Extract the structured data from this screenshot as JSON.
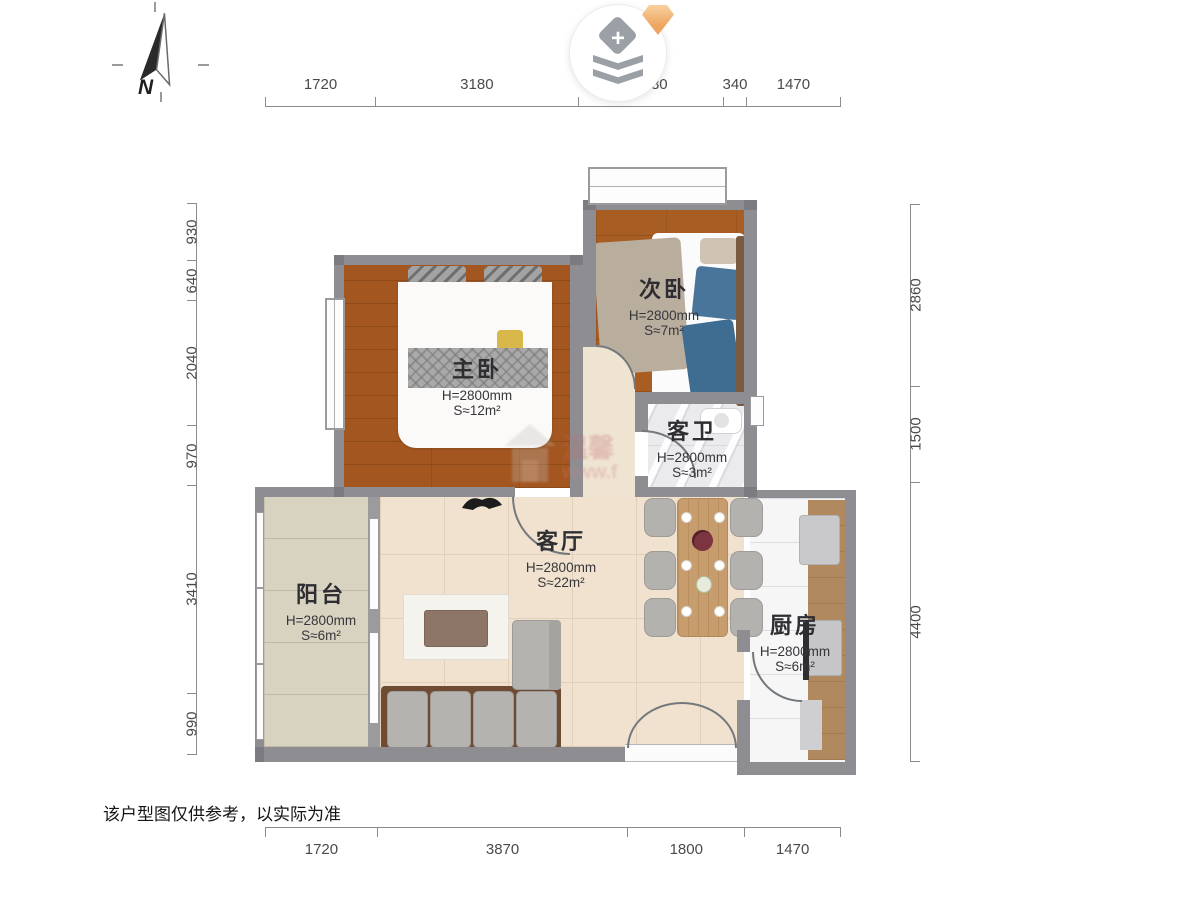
{
  "compass": {
    "label": "N"
  },
  "logo": {
    "plus": "+"
  },
  "watermark": {
    "line1": "温馨",
    "line2": "www.f"
  },
  "rooms": {
    "master": {
      "name": "主卧",
      "height": "H=2800mm",
      "area": "S≈12m²"
    },
    "second": {
      "name": "次卧",
      "height": "H=2800mm",
      "area": "S≈7m²"
    },
    "bath": {
      "name": "客卫",
      "height": "H=2800mm",
      "area": "S≈3m²"
    },
    "living": {
      "name": "客厅",
      "height": "H=2800mm",
      "area": "S≈22m²"
    },
    "balcony": {
      "name": "阳台",
      "height": "H=2800mm",
      "area": "S≈6m²"
    },
    "kitchen": {
      "name": "厨房",
      "height": "H=2800mm",
      "area": "S≈6m²"
    }
  },
  "dimensions": {
    "top": [
      "1720",
      "3180",
      "2280",
      "340",
      "1470"
    ],
    "bottom": [
      "1720",
      "3870",
      "1800",
      "1470"
    ],
    "left": [
      "930",
      "640",
      "2040",
      "970",
      "3410",
      "990"
    ],
    "right": [
      "2860",
      "1500",
      "4400"
    ]
  },
  "footer": {
    "disclaimer": "该户型图仅供参考，以实际为准"
  }
}
